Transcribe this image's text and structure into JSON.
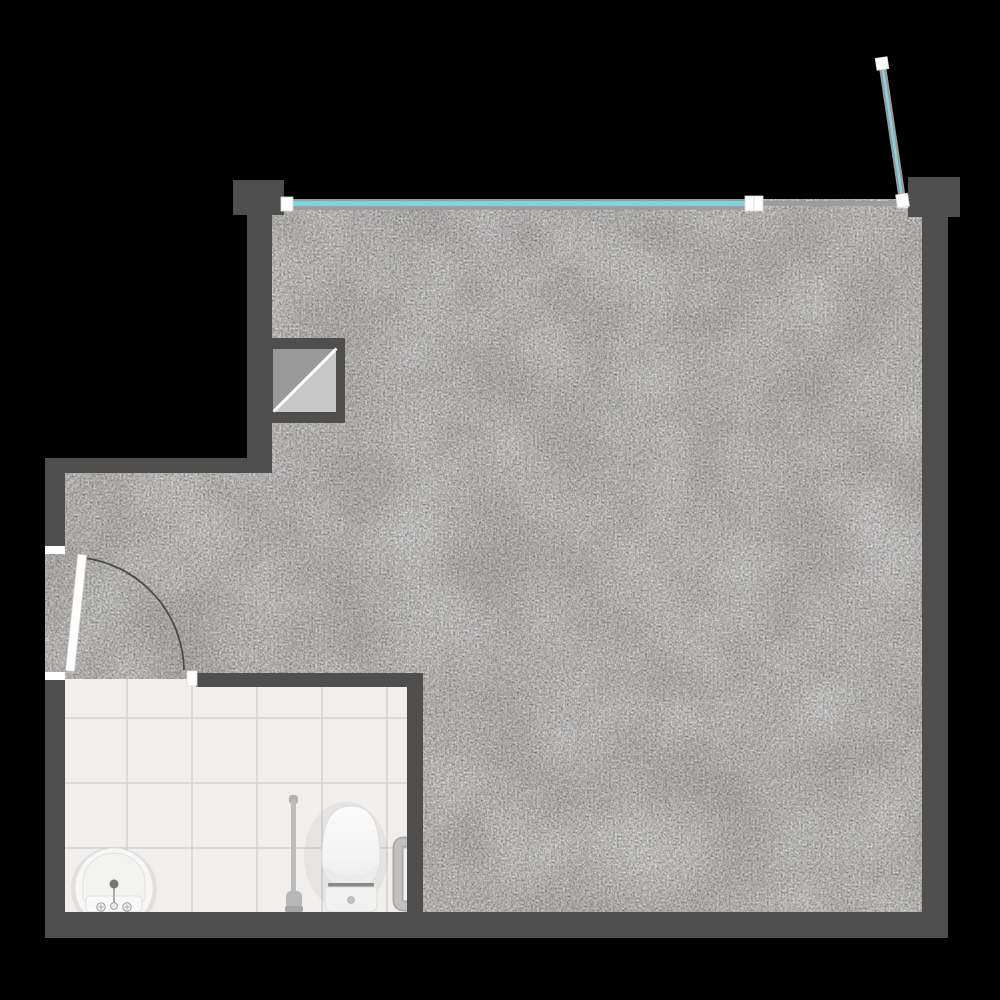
{
  "scene": {
    "type": "architectural-floor-plan",
    "background": "#000000",
    "rooms": [
      {
        "name": "main-room",
        "floor": "concrete"
      },
      {
        "name": "bathroom",
        "floor": "white-tile"
      }
    ]
  },
  "colors": {
    "background": "#000000",
    "wall": "#4e4e4e",
    "floor": "#c6c4c2",
    "tile": "#f0efed",
    "grout": "#d4d3d1",
    "window_glass": "#7fd6e2",
    "window_frame": "#9c9c9c",
    "cap_white": "#ffffff",
    "shaft_dark": "#9a9a9a",
    "shaft_light": "#c8c8c8",
    "door_leaf": "#ffffff",
    "swing_arc": "#4a4a4a",
    "fixture_white": "#f7f7f7",
    "fixture_light": "#f1f1f1",
    "fixture_gray": "#bcbcbc",
    "fixture_dark": "#8a8a8a",
    "faucet_dot": "#757575"
  },
  "features": {
    "window_wall": "glazed-window-strip-top",
    "open_pane": "open-window-pane-top-right",
    "entry_door": "swing-door-left-wall",
    "shaft": "duct-shaft-diagonal-symbol"
  },
  "fixtures": [
    {
      "name": "washbasin"
    },
    {
      "name": "toilet"
    },
    {
      "name": "toilet-brush"
    },
    {
      "name": "grab-bar"
    }
  ]
}
